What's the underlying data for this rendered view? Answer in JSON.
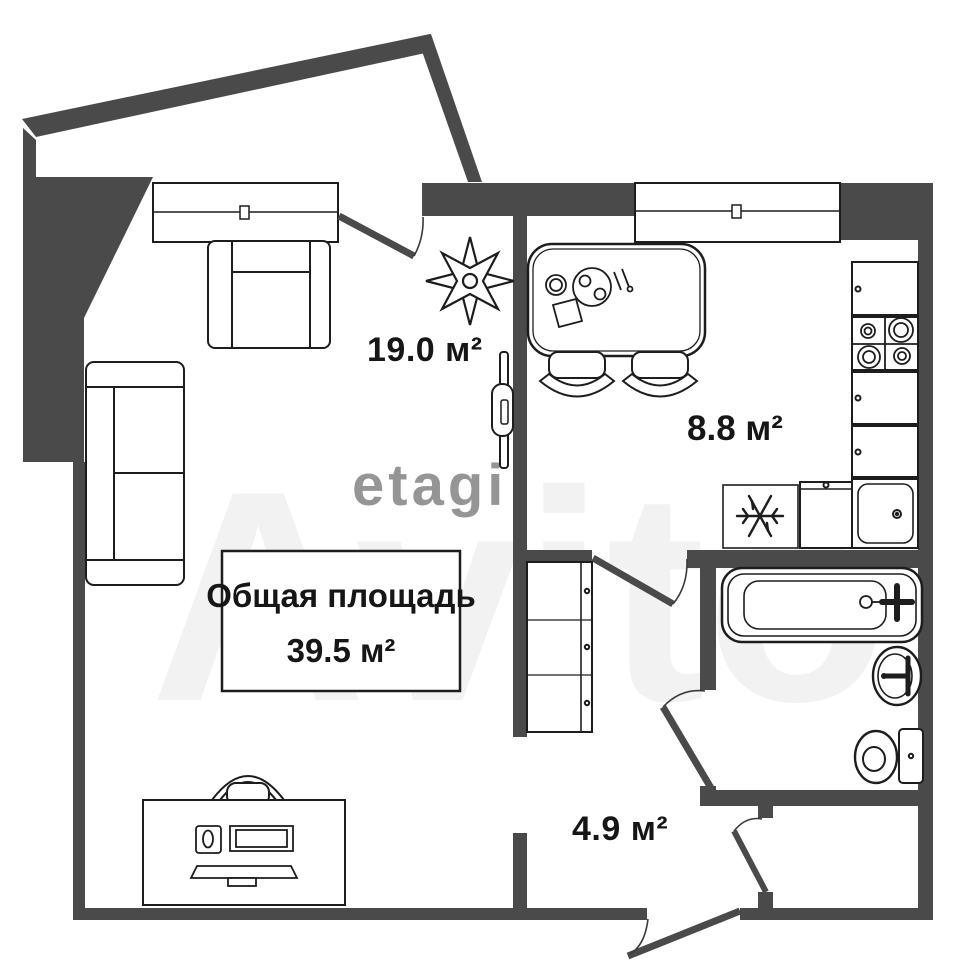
{
  "floorplan": {
    "title_label": "Общая площадь",
    "total_area_label": "39.5 м²",
    "rooms": {
      "living_room": {
        "area_label": "19.0 м²"
      },
      "kitchen": {
        "area_label": "8.8 м²"
      },
      "hallway": {
        "area_label": "4.9 м²"
      }
    },
    "watermark_primary": "etagi",
    "watermark_secondary": "Avito",
    "colors": {
      "wall": "#4a4a4a",
      "outline": "#1d1d1d",
      "arc": "#3a3a3a",
      "background": "#ffffff",
      "watermark_pink": "#d9b3b3",
      "watermark_gray": "#c9c9c9"
    }
  }
}
